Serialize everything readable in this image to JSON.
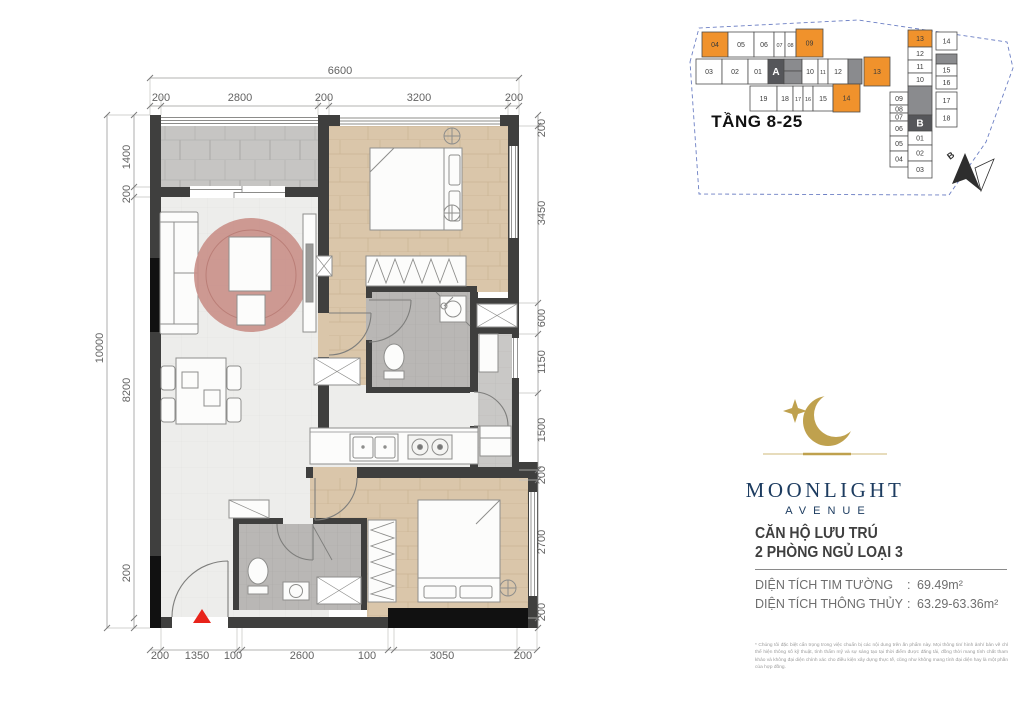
{
  "brand": {
    "name": "MOONLIGHT",
    "sub": "AVENUE"
  },
  "unit": {
    "title_line1": "CĂN HỘ LƯU TRÚ",
    "title_line2": "2 PHÒNG NGỦ LOẠI 3",
    "colon": ":",
    "area_rows": [
      {
        "label": "DIỆN TÍCH TIM TƯỜNG",
        "value": "69.49m²"
      },
      {
        "label": "DIỆN TÍCH THÔNG THỦY",
        "value": "63.29-63.36m²"
      }
    ]
  },
  "disclaimer": {
    "text": "* Chúng tôi đặc biệt cẩn trọng trong việc chuẩn bị các nội dung trên ấn phẩm này. Mọi thông tin/ hình ảnh/ bản vẽ chỉ thể hiện thông số kỹ thuật, tính thẩm mỹ và sự sáng tạo tại thời điểm được đăng tải, đồng thời mang tính chất tham khảo và không đại diện chính xác cho điều kiện xây dựng thực tế, cũng như không mang tính đại diện hay là một phần của hợp đồng."
  },
  "keyplan": {
    "floors_label": "TẦNG 8-25",
    "north_label": "B",
    "colors": {
      "highlight": "#F0922C",
      "dark": "#55565A",
      "gray": "#8A8B8E",
      "stroke": "#4D4D4D"
    },
    "units": [
      {
        "label": "04",
        "x": 702,
        "y": 32,
        "w": 26,
        "h": 25,
        "t": "o"
      },
      {
        "label": "05",
        "x": 728,
        "y": 32,
        "w": 26,
        "h": 25,
        "t": "n"
      },
      {
        "label": "06",
        "x": 754,
        "y": 32,
        "w": 20,
        "h": 25,
        "t": "n"
      },
      {
        "label": "07",
        "x": 774,
        "y": 32,
        "w": 11,
        "h": 25,
        "t": "n"
      },
      {
        "label": "08",
        "x": 785,
        "y": 32,
        "w": 11,
        "h": 25,
        "t": "n"
      },
      {
        "label": "09",
        "x": 796,
        "y": 29,
        "w": 27,
        "h": 28,
        "t": "o"
      },
      {
        "label": "03",
        "x": 696,
        "y": 59,
        "w": 26,
        "h": 25,
        "t": "n"
      },
      {
        "label": "02",
        "x": 722,
        "y": 59,
        "w": 26,
        "h": 25,
        "t": "n"
      },
      {
        "label": "01",
        "x": 748,
        "y": 59,
        "w": 20,
        "h": 25,
        "t": "n"
      },
      {
        "label": "A",
        "x": 768,
        "y": 59,
        "w": 16,
        "h": 25,
        "t": "d"
      },
      {
        "label": "",
        "x": 784,
        "y": 59,
        "w": 18,
        "h": 12,
        "t": "g"
      },
      {
        "label": "",
        "x": 784,
        "y": 71,
        "w": 18,
        "h": 13,
        "t": "g"
      },
      {
        "label": "10",
        "x": 802,
        "y": 59,
        "w": 16,
        "h": 25,
        "t": "n"
      },
      {
        "label": "11",
        "x": 818,
        "y": 59,
        "w": 10,
        "h": 25,
        "t": "n"
      },
      {
        "label": "12",
        "x": 828,
        "y": 59,
        "w": 20,
        "h": 25,
        "t": "n"
      },
      {
        "label": "",
        "x": 848,
        "y": 59,
        "w": 14,
        "h": 25,
        "t": "g"
      },
      {
        "label": "13",
        "x": 864,
        "y": 57,
        "w": 26,
        "h": 29,
        "t": "o"
      },
      {
        "label": "19",
        "x": 750,
        "y": 86,
        "w": 27,
        "h": 25,
        "t": "n"
      },
      {
        "label": "18",
        "x": 777,
        "y": 86,
        "w": 16,
        "h": 25,
        "t": "n"
      },
      {
        "label": "17",
        "x": 793,
        "y": 86,
        "w": 10,
        "h": 25,
        "t": "n"
      },
      {
        "label": "16",
        "x": 803,
        "y": 86,
        "w": 10,
        "h": 25,
        "t": "n"
      },
      {
        "label": "15",
        "x": 813,
        "y": 86,
        "w": 20,
        "h": 25,
        "t": "n"
      },
      {
        "label": "14",
        "x": 833,
        "y": 84,
        "w": 27,
        "h": 28,
        "t": "o"
      },
      {
        "label": "09",
        "x": 890,
        "y": 92,
        "w": 18,
        "h": 13,
        "t": "n"
      },
      {
        "label": "08",
        "x": 890,
        "y": 105,
        "w": 18,
        "h": 8,
        "t": "n"
      },
      {
        "label": "07",
        "x": 890,
        "y": 113,
        "w": 18,
        "h": 8,
        "t": "n"
      },
      {
        "label": "06",
        "x": 890,
        "y": 121,
        "w": 18,
        "h": 15,
        "t": "n"
      },
      {
        "label": "05",
        "x": 890,
        "y": 136,
        "w": 18,
        "h": 15,
        "t": "n"
      },
      {
        "label": "04",
        "x": 890,
        "y": 151,
        "w": 18,
        "h": 16,
        "t": "n"
      },
      {
        "label": "13",
        "x": 908,
        "y": 30,
        "w": 24,
        "h": 17,
        "t": "o"
      },
      {
        "label": "12",
        "x": 908,
        "y": 47,
        "w": 24,
        "h": 13,
        "t": "n"
      },
      {
        "label": "11",
        "x": 908,
        "y": 60,
        "w": 24,
        "h": 13,
        "t": "n"
      },
      {
        "label": "10",
        "x": 908,
        "y": 73,
        "w": 24,
        "h": 13,
        "t": "n"
      },
      {
        "label": "",
        "x": 908,
        "y": 86,
        "w": 24,
        "h": 29,
        "t": "g"
      },
      {
        "label": "B",
        "x": 908,
        "y": 115,
        "w": 24,
        "h": 16,
        "t": "d"
      },
      {
        "label": "01",
        "x": 908,
        "y": 131,
        "w": 24,
        "h": 14,
        "t": "n"
      },
      {
        "label": "02",
        "x": 908,
        "y": 145,
        "w": 24,
        "h": 16,
        "t": "n"
      },
      {
        "label": "03",
        "x": 908,
        "y": 161,
        "w": 24,
        "h": 17,
        "t": "n"
      },
      {
        "label": "14",
        "x": 936,
        "y": 32,
        "w": 21,
        "h": 18,
        "t": "n"
      },
      {
        "label": "",
        "x": 936,
        "y": 54,
        "w": 21,
        "h": 10,
        "t": "g"
      },
      {
        "label": "15",
        "x": 936,
        "y": 64,
        "w": 21,
        "h": 12,
        "t": "n"
      },
      {
        "label": "16",
        "x": 936,
        "y": 76,
        "w": 21,
        "h": 13,
        "t": "n"
      },
      {
        "label": "17",
        "x": 936,
        "y": 92,
        "w": 21,
        "h": 17,
        "t": "n"
      },
      {
        "label": "18",
        "x": 936,
        "y": 109,
        "w": 21,
        "h": 18,
        "t": "n"
      }
    ]
  },
  "plan": {
    "entrance_marker_color": "#E8231A",
    "dim_labels": [
      {
        "t": "6600",
        "x": 340,
        "y": 74,
        "r": 0
      },
      {
        "t": "200",
        "x": 161,
        "y": 101,
        "r": 0
      },
      {
        "t": "2800",
        "x": 240,
        "y": 101,
        "r": 0
      },
      {
        "t": "200",
        "x": 324,
        "y": 101,
        "r": 0
      },
      {
        "t": "3200",
        "x": 419,
        "y": 101,
        "r": 0
      },
      {
        "t": "200",
        "x": 514,
        "y": 101,
        "r": 0
      },
      {
        "t": "10000",
        "x": 103,
        "y": 348,
        "r": -90
      },
      {
        "t": "1400",
        "x": 130,
        "y": 157,
        "r": -90
      },
      {
        "t": "200",
        "x": 130,
        "y": 194,
        "r": -90
      },
      {
        "t": "8200",
        "x": 130,
        "y": 390,
        "r": -90
      },
      {
        "t": "200",
        "x": 130,
        "y": 573,
        "r": -90
      },
      {
        "t": "200",
        "x": 545,
        "y": 128,
        "r": -90
      },
      {
        "t": "3450",
        "x": 545,
        "y": 213,
        "r": -90
      },
      {
        "t": "600",
        "x": 545,
        "y": 318,
        "r": -90
      },
      {
        "t": "1150",
        "x": 545,
        "y": 362,
        "r": -90
      },
      {
        "t": "1500",
        "x": 545,
        "y": 430,
        "r": -90
      },
      {
        "t": "200",
        "x": 545,
        "y": 475,
        "r": -90
      },
      {
        "t": "2700",
        "x": 545,
        "y": 542,
        "r": -90
      },
      {
        "t": "200",
        "x": 545,
        "y": 612,
        "r": -90
      },
      {
        "t": "200",
        "x": 160,
        "y": 659,
        "r": 0
      },
      {
        "t": "1350",
        "x": 197,
        "y": 659,
        "r": 0
      },
      {
        "t": "100",
        "x": 233,
        "y": 659,
        "r": 0
      },
      {
        "t": "2600",
        "x": 302,
        "y": 659,
        "r": 0
      },
      {
        "t": "100",
        "x": 367,
        "y": 659,
        "r": 0
      },
      {
        "t": "3050",
        "x": 442,
        "y": 659,
        "r": 0
      },
      {
        "t": "200",
        "x": 523,
        "y": 659,
        "r": 0
      }
    ]
  }
}
